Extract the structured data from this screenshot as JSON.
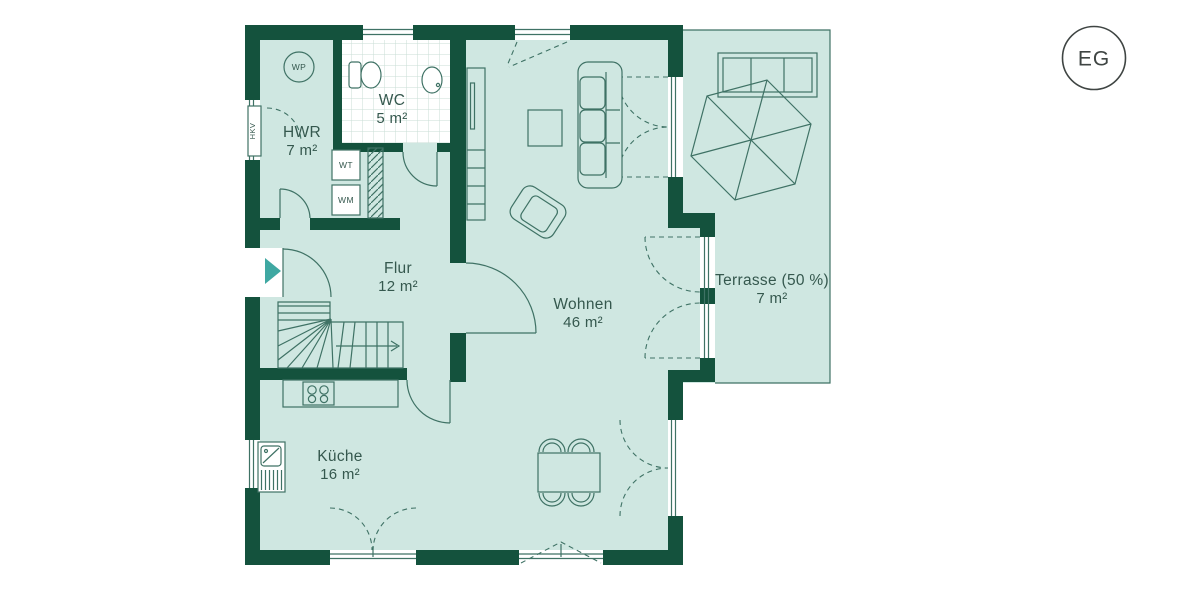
{
  "floor_badge": {
    "label": "EG"
  },
  "rooms": {
    "hwr": {
      "name": "HWR",
      "area": "7 m²"
    },
    "wc": {
      "name": "WC",
      "area": "5 m²"
    },
    "flur": {
      "name": "Flur",
      "area": "12 m²"
    },
    "wohnen": {
      "name": "Wohnen",
      "area": "46 m²"
    },
    "kueche": {
      "name": "Küche",
      "area": "16 m²"
    },
    "terrasse": {
      "name": "Terrasse (50 %)",
      "area": "7 m²"
    }
  },
  "labels": {
    "heat_pump": "WP",
    "heating_circuit": "HKV",
    "dryer": "WT",
    "washer": "WM"
  },
  "colors": {
    "wall": "#14523d",
    "room_fill": "#cfe7e1",
    "line": "#3f7265",
    "text": "#35584e",
    "entrance_arrow": "#3fa8a2",
    "badge": "#3f4543",
    "tile_line": "#c9ddd6",
    "background": "#ffffff"
  }
}
